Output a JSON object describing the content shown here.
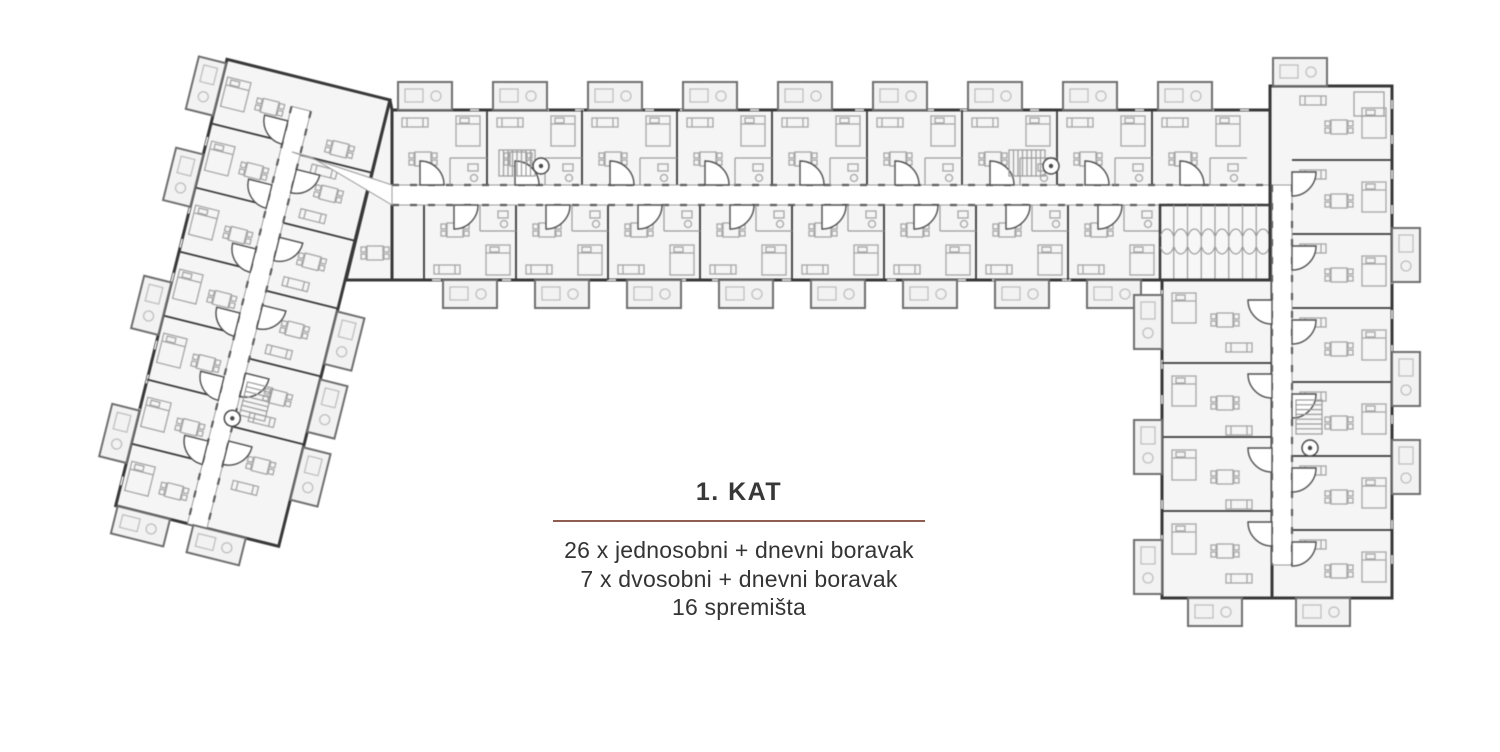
{
  "legend": {
    "title": "1. KAT",
    "divider_color": "#8e5c51",
    "lines": [
      "26 x jednosobni + dnevni boravak",
      "7 x dvosobni + dnevni boravak",
      "16 spremišta"
    ]
  },
  "floorplan": {
    "type": "architectural-floor-plan",
    "wings": [
      "left-angled",
      "top-horizontal",
      "right-vertical"
    ],
    "colors": {
      "wall": "#383838",
      "unit_fill": "#f5f5f5",
      "furniture": "#a6a6a6",
      "balcony_stroke": "#6e6e6e",
      "corridor": "#ffffff"
    }
  }
}
